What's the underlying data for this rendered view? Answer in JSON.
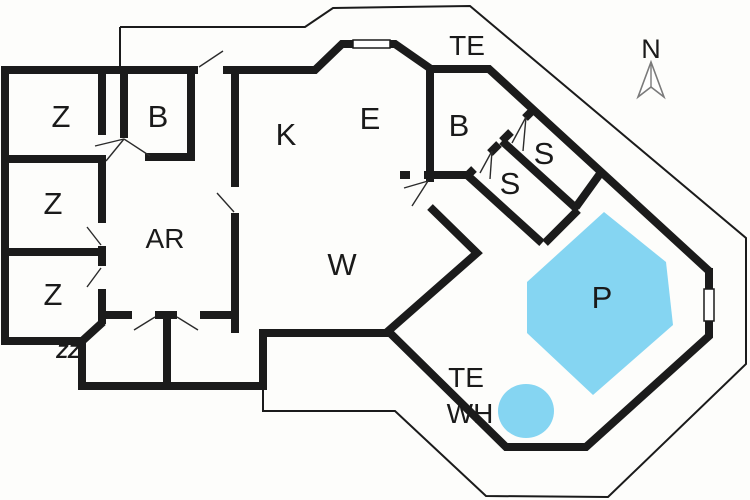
{
  "meta": {
    "type": "house-floor-plan"
  },
  "colors": {
    "background": "#fdfdfb",
    "wall": "#1b1b1b",
    "pool": "#85d5f2",
    "pool_label": "#1c2a40",
    "label": "#1a1a1a",
    "compass_outline": "#7a7a7a"
  },
  "labels": {
    "room_z1": "Z",
    "room_z2": "Z",
    "room_z3": "Z",
    "room_b1": "B",
    "room_k": "K",
    "room_e": "E",
    "room_ar": "AR",
    "room_w": "W",
    "room_b2": "B",
    "room_s1": "S",
    "room_s2": "S",
    "terrace_top": "TE",
    "terrace_pool": "TE",
    "whirlpool": "WH",
    "pool": "P",
    "compass_north": "N",
    "corner_mark": "ZZ"
  }
}
